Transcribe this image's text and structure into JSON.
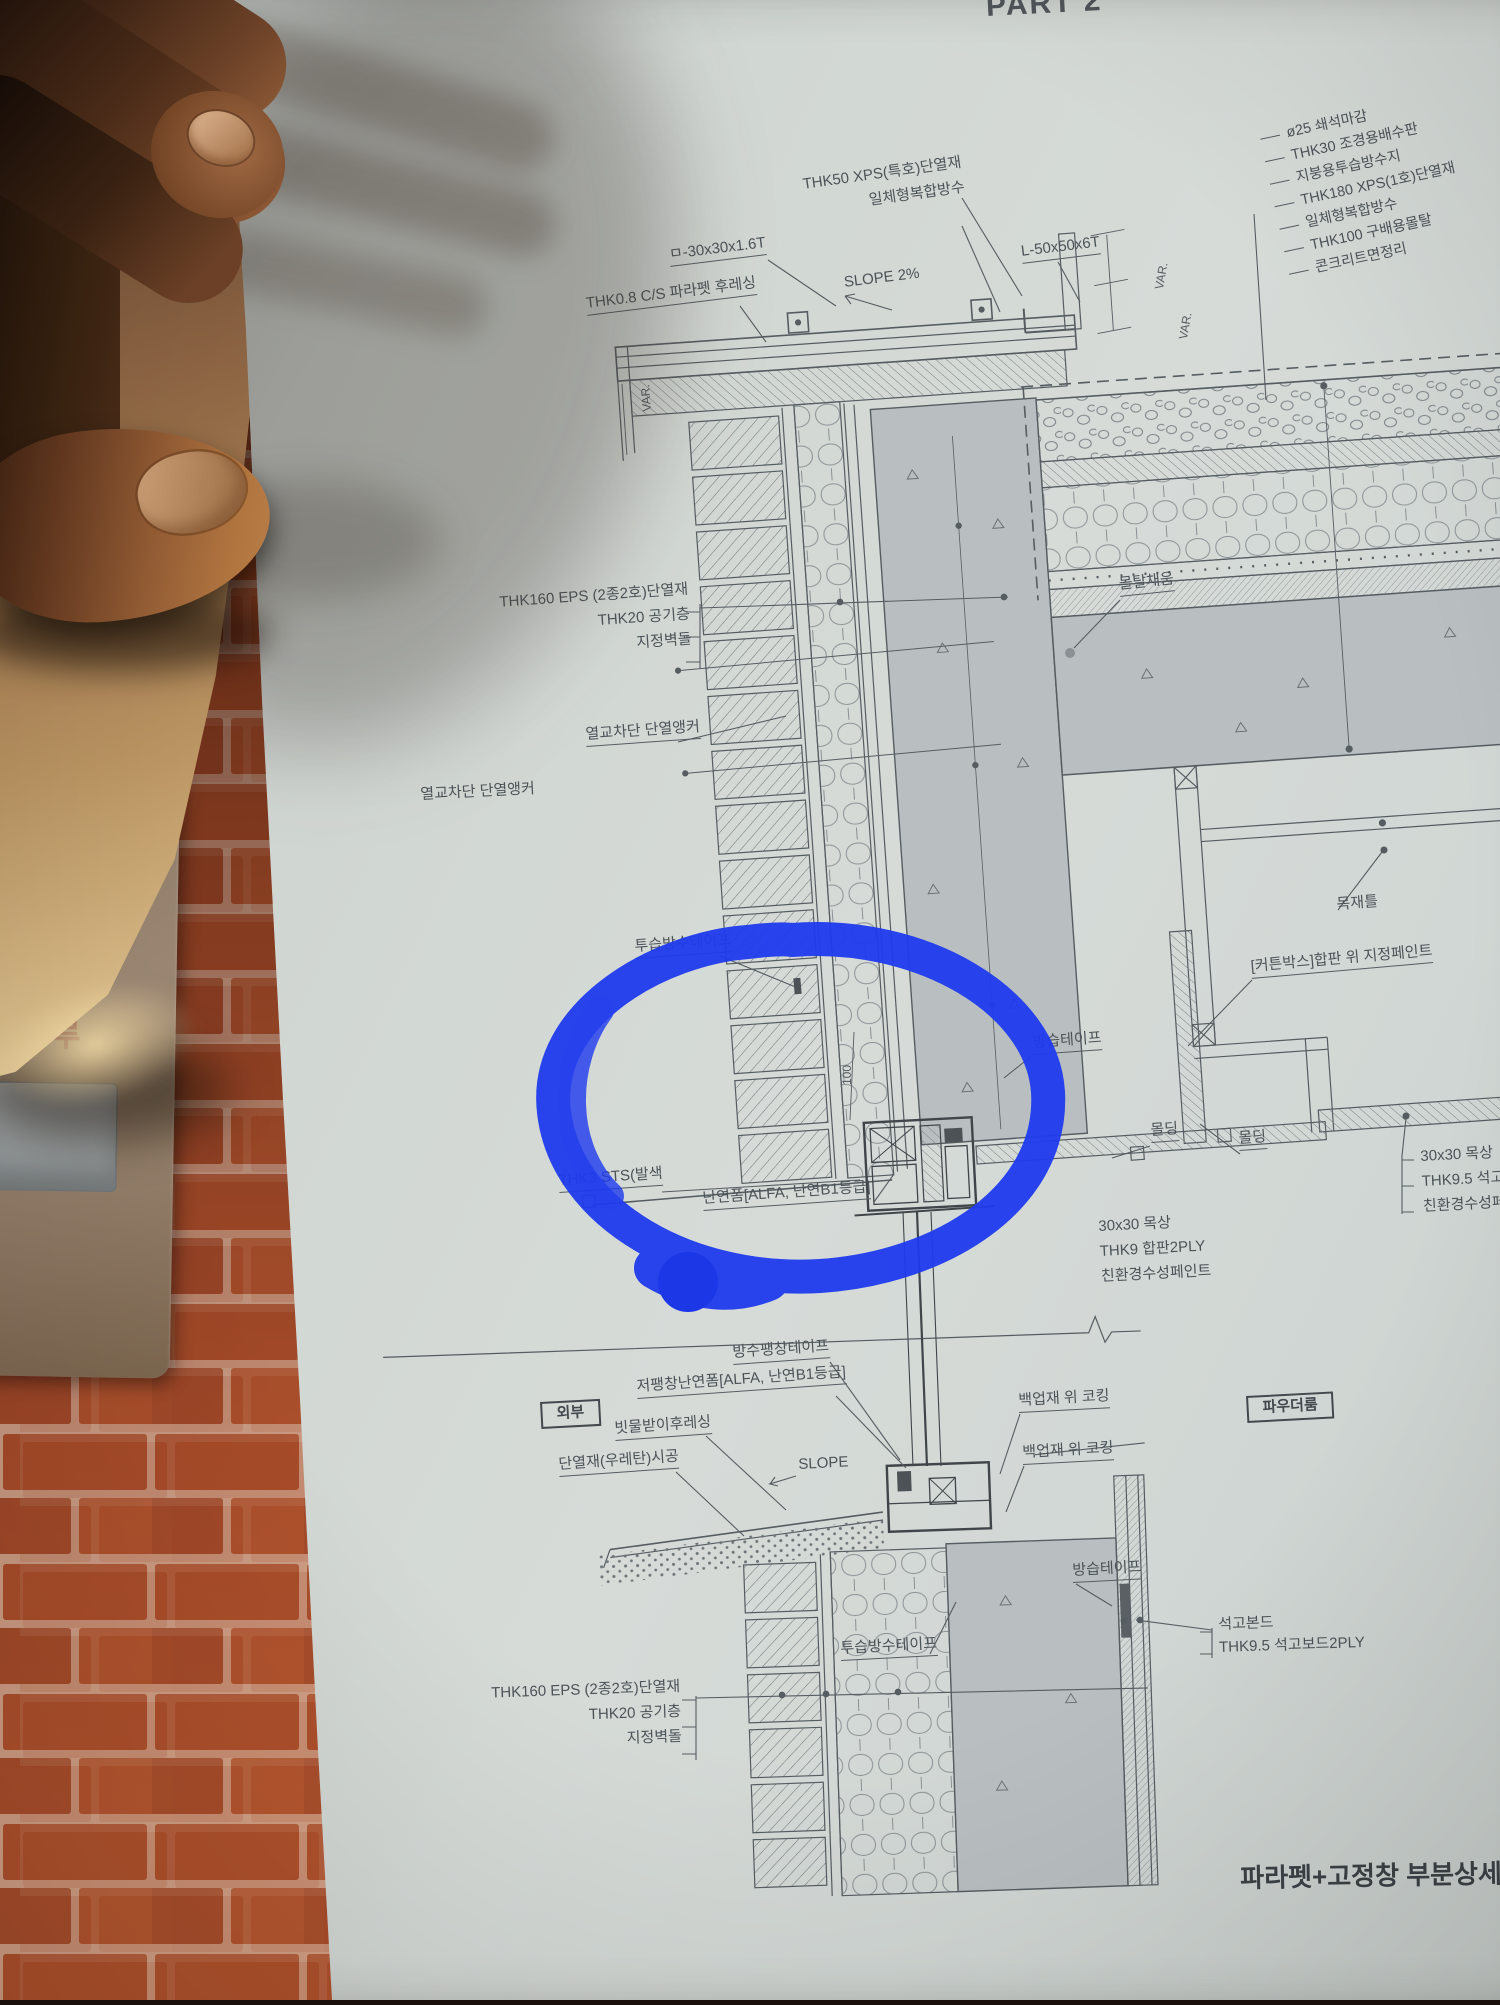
{
  "photo": {
    "background": "brick-wall",
    "book_spine_text": "하루",
    "brick_color": "#ad4e2b",
    "mortar_color": "#d2a189",
    "page_color": "#d2d7d4"
  },
  "annotation": {
    "marker_circle_color": "#1f3bee"
  },
  "drawing": {
    "part_header": "PART 2",
    "sheet_title": "파라펫+고정창 부분상세도",
    "line_color": "#565d61",
    "upper": {
      "cap_insulation": "THK50 XPS(특호)단열재",
      "cap_waterproof": "일체형복합방수",
      "square_tube": "ㅁ-30x30x1.6T",
      "slope_2pct": "SLOPE 2%",
      "angle": "L-50x50x6T",
      "parapet_flashing": "THK0.8 C/S 파라펫 후레싱",
      "var_left": "VAR.",
      "var_right_1": "VAR.",
      "var_right_2": "VAR.",
      "roof_layers": [
        "ø25 쇄석마감",
        "THK30 조경용배수판",
        "지붕용투습방수지",
        "THK180 XPS(1호)단열재",
        "일체형복합방수",
        "THK100 구배용몰탈",
        "콘크리트면정리"
      ],
      "wall_layers": [
        "THK160 EPS (2종2호)단열재",
        "THK20 공기층",
        "지정벽돌"
      ],
      "thermal_anchor_a": "열교차단 단열앵커",
      "thermal_anchor_b": "열교차단 단열앵커",
      "mortar_fill": "몰탈채움",
      "breathable_tape": "투습방수테이프",
      "wood_frame": "목재틀",
      "curtain_box": "[커튼박스]합판 위 지정페인트",
      "vapor_tape": "방습테이프",
      "molding_a": "몰딩",
      "molding_b": "몰딩",
      "ceiling_layers": [
        "30x30 목상",
        "THK9.5 석고보드",
        "친환경수성페인트"
      ],
      "sts_flashing": "THK3 STS(발색",
      "flame_foam": "난연폼[ALFA, 난연B1등급]",
      "soffit_layers": [
        "30x30 목상",
        "THK9 합판2PLY",
        "친환경수성페인트"
      ],
      "dim_100": "100"
    },
    "lower": {
      "expansion_tape": "방수팽창테이프",
      "low_expansion_foam": "저팽창난연폼[ALFA, 난연B1등급]",
      "exterior": "외부",
      "rain_flashing": "빗물받이후레싱",
      "urethane": "단열재(우레탄)시공",
      "slope": "SLOPE",
      "backer_caulk_a": "백업재 위 코킹",
      "backer_caulk_b": "백업재 위 코킹",
      "powder_room": "파우더룸",
      "vapor_tape": "방습테이프",
      "gypsum_bond": "석고본드",
      "gypsum_board": "THK9.5 석고보드2PLY",
      "breathable_tape": "투습방수테이프",
      "wall_layers": [
        "THK160 EPS (2종2호)단열재",
        "THK20 공기층",
        "지정벽돌"
      ]
    }
  }
}
